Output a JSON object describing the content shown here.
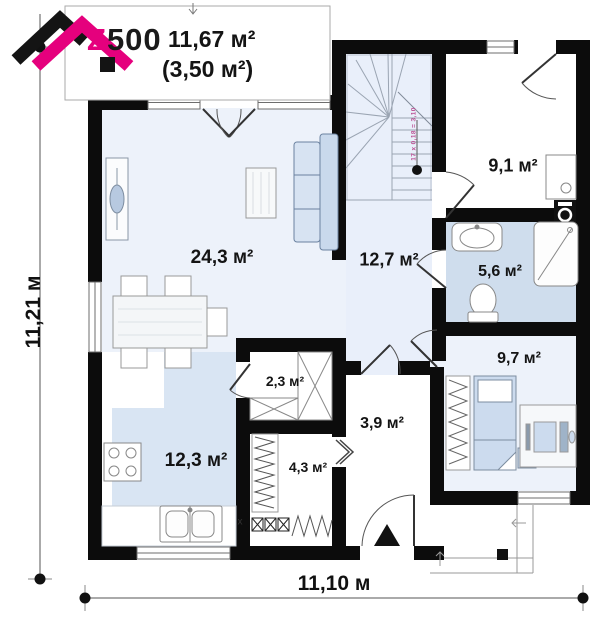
{
  "logo": {
    "brand": "Z500",
    "area_main": "11,67 м²",
    "area_secondary": "(3,50 м²)"
  },
  "dimensions": {
    "overall_width": "11,10 м",
    "overall_height": "11,21 м"
  },
  "stairs": {
    "note": "17 x 0,18 = 3,10"
  },
  "rooms": [
    {
      "name": "living-room",
      "area": "24,3 м²"
    },
    {
      "name": "hall",
      "area": "12,7 м²"
    },
    {
      "name": "kitchen",
      "area": "12,3 м²"
    },
    {
      "name": "room",
      "area": "9,1 м²"
    },
    {
      "name": "bathroom",
      "area": "5,6 м²"
    },
    {
      "name": "bedroom",
      "area": "9,7 м²"
    },
    {
      "name": "pantry",
      "area": "2,3 м²"
    },
    {
      "name": "entry",
      "area": "3,9 м²"
    },
    {
      "name": "utility",
      "area": "4,3 м²"
    }
  ],
  "markers": {
    "kitchen_appliance": "x"
  },
  "colors": {
    "brand_magenta": "#e5007d",
    "wall_black": "#0c0c0c",
    "floor_light_blue": "#edf2fa",
    "kitchen_floor_blue": "#d9e5f3",
    "bathroom_floor_blue": "#cfdded",
    "furniture_blue": "#c9d9ec",
    "stair_note_pink": "#bb4f93"
  }
}
